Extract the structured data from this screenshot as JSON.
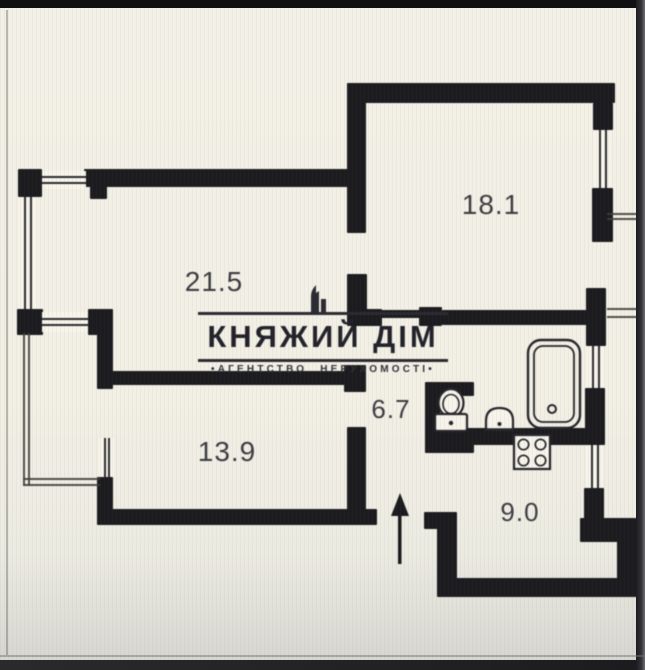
{
  "logo": {
    "title": "КНЯЖИЙ ДІМ",
    "subtitle": "•АГЕНТСТВО НЕРУХОМОСТІ•",
    "icon": "building-skyline-icon"
  },
  "colors": {
    "wall": "#1c1c20",
    "background": "#f2efe5",
    "label_text": "#3c3c41",
    "logo_text": "#22222a",
    "thin_line": "#3e3e38"
  },
  "plan": {
    "rooms": [
      {
        "id": "living-room",
        "area": "21.5"
      },
      {
        "id": "bedroom-top-right",
        "area": "18.1"
      },
      {
        "id": "bedroom-bottom-left",
        "area": "13.9"
      },
      {
        "id": "hallway",
        "area": "6.7"
      },
      {
        "id": "kitchen",
        "area": "9.0"
      }
    ],
    "fixtures": [
      "bathtub",
      "toilet",
      "sink",
      "stove",
      "entrance-arrow"
    ],
    "walls": [
      [
        18,
        169,
        24,
        28
      ],
      [
        84,
        169,
        268,
        18
      ],
      [
        90,
        186,
        17,
        13
      ],
      [
        17,
        309,
        26,
        26
      ],
      [
        88,
        309,
        25,
        26
      ],
      [
        97,
        333,
        16,
        56
      ],
      [
        97,
        477,
        16,
        48
      ],
      [
        110,
        509,
        267,
        16
      ],
      [
        112,
        371,
        243,
        14
      ],
      [
        344,
        365,
        22,
        27
      ],
      [
        347,
        427,
        19,
        98
      ],
      [
        347,
        83,
        19,
        150
      ],
      [
        347,
        274,
        20,
        40
      ],
      [
        347,
        309,
        35,
        17
      ],
      [
        347,
        83,
        268,
        20
      ],
      [
        593,
        103,
        20,
        27
      ],
      [
        592,
        188,
        21,
        54
      ],
      [
        586,
        288,
        20,
        58
      ],
      [
        585,
        388,
        20,
        57
      ],
      [
        584,
        488,
        20,
        36
      ],
      [
        580,
        518,
        57,
        24
      ],
      [
        617,
        532,
        20,
        63
      ],
      [
        437,
        578,
        200,
        19
      ],
      [
        437,
        528,
        20,
        52
      ],
      [
        424,
        512,
        33,
        17
      ],
      [
        366,
        310,
        56,
        8
      ],
      [
        419,
        307,
        23,
        19
      ],
      [
        442,
        310,
        146,
        15
      ],
      [
        425,
        382,
        15,
        71
      ],
      [
        428,
        382,
        46,
        14
      ],
      [
        425,
        430,
        49,
        23
      ],
      [
        464,
        428,
        126,
        17
      ]
    ],
    "windows": [
      {
        "x": 42,
        "y": 171,
        "w": 44,
        "h": 18,
        "dir": "h"
      },
      {
        "x": 19,
        "y": 197,
        "w": 18,
        "h": 112,
        "dir": "v"
      },
      {
        "x": 42,
        "y": 312,
        "w": 46,
        "h": 20,
        "dir": "h"
      },
      {
        "x": 99,
        "y": 438,
        "w": 15,
        "h": 39,
        "dir": "v"
      },
      {
        "x": 594,
        "y": 130,
        "w": 17,
        "h": 58,
        "dir": "v"
      },
      {
        "x": 587,
        "y": 346,
        "w": 17,
        "h": 42,
        "dir": "v"
      },
      {
        "x": 586,
        "y": 445,
        "w": 17,
        "h": 43,
        "dir": "v"
      }
    ],
    "balcony_lines": [
      [
        23,
        333,
        2,
        153
      ],
      [
        28,
        333,
        2,
        153
      ],
      [
        23,
        478,
        77,
        2
      ],
      [
        23,
        484,
        77,
        2
      ],
      [
        607,
        213,
        34,
        2
      ],
      [
        607,
        218,
        34,
        2
      ],
      [
        639,
        213,
        2,
        109
      ],
      [
        607,
        308,
        34,
        2
      ],
      [
        607,
        316,
        34,
        2
      ]
    ]
  }
}
